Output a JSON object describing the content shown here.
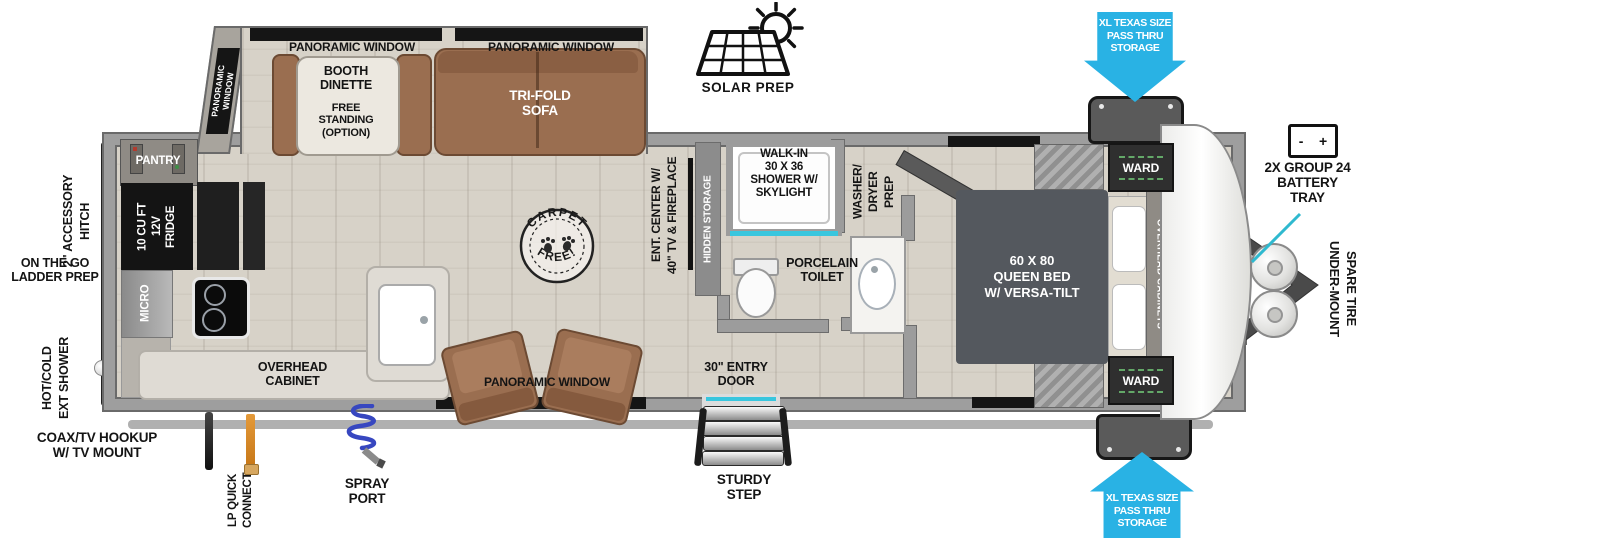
{
  "colors": {
    "accent_blue": "#29b2e4",
    "teal_pointer": "#2fb9cf",
    "door_cyan": "#38c6de",
    "furniture_brown": "#9a6e50",
    "bed_gray": "#54585e",
    "wall_gray": "#9c9c9c",
    "lp_orange": "#d98a2b",
    "hose_blue": "#3747c0"
  },
  "exterior": {
    "solar_prep": "SOLAR PREP",
    "pass_thru_top": "XL TEXAS SIZE\nPASS THRU\nSTORAGE",
    "pass_thru_bottom": "XL TEXAS SIZE\nPASS THRU\nSTORAGE",
    "battery_tray": "2X GROUP 24\nBATTERY\nTRAY",
    "battery_minus": "-",
    "battery_plus": "+",
    "spare_tire": "UNDER-MOUNT\nSPARE TIRE",
    "accessory_hitch": "2\" ACCESSORY\nHITCH",
    "ladder_prep": "ON THE GO\nLADDER PREP",
    "ext_shower": "HOT/COLD\nEXT SHOWER",
    "coax_hookup": "COAX/TV HOOKUP\nW/ TV MOUNT",
    "lp_quick_connect": "LP QUICK\nCONNECT",
    "spray_port": "SPRAY\nPORT",
    "entry_door": "30\" ENTRY\nDOOR",
    "sturdy_step": "STURDY\nSTEP"
  },
  "slideout": {
    "panoramic_window_side": "PANORAMIC\nWINDOW",
    "panoramic_window_top_left": "PANORAMIC WINDOW",
    "panoramic_window_top_right": "PANORAMIC WINDOW",
    "booth_dinette": "BOOTH\nDINETTE",
    "booth_dinette_option": "FREE\nSTANDING\n(OPTION)",
    "trifold_sofa": "TRI-FOLD\nSOFA"
  },
  "kitchen": {
    "pantry": "PANTRY",
    "fridge": "10 CU FT\n12V\nFRIDGE",
    "micro": "MICRO",
    "overhead_cabinet": "OVERHEAD\nCABINET"
  },
  "living": {
    "carpet_free_line1": "CARPET",
    "carpet_free_line2": "FREE!",
    "panoramic_window_bottom": "PANORAMIC WINDOW",
    "ent_center": "ENT. CENTER W/\n40\" TV & FIREPLACE",
    "hidden_storage": "HIDDEN STORAGE"
  },
  "bathroom": {
    "shower": "WALK-IN\n30 X 36\nSHOWER W/\nSKYLIGHT",
    "toilet": "PORCELAIN\nTOILET",
    "washer_dryer": "WASHER/\nDRYER\nPREP"
  },
  "bedroom": {
    "bed": "60 X 80\nQUEEN BED\nW/ VERSA-TILT",
    "ward_top": "WARD",
    "ward_bottom": "WARD",
    "overhead_cabinets": "OVERHEAD CABINETS"
  }
}
